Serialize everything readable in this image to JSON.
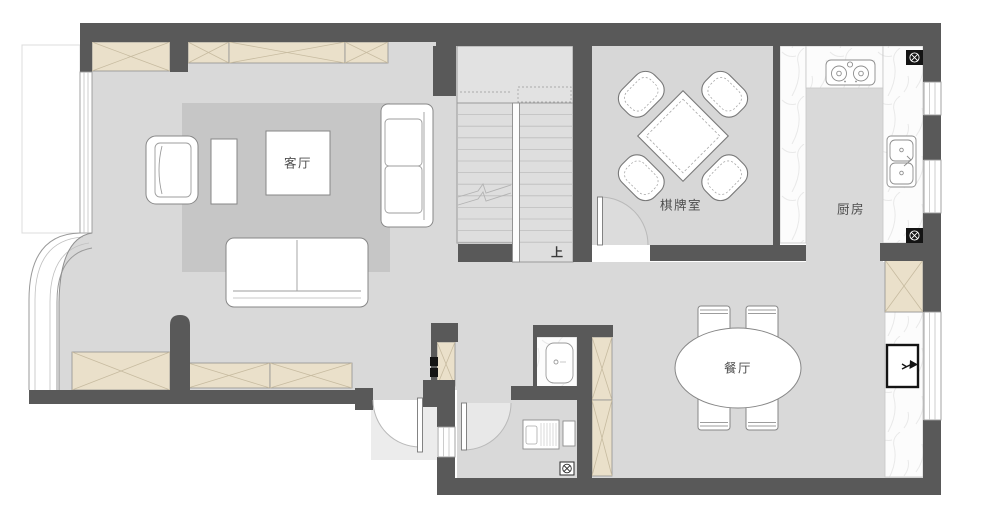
{
  "plan": {
    "type": "residential-floor-plan",
    "rooms": {
      "living_room": {
        "label": "客厅"
      },
      "game_room": {
        "label": "棋牌室"
      },
      "kitchen": {
        "label": "厨房"
      },
      "dining_room": {
        "label": "餐厅"
      }
    },
    "stairs": {
      "direction_label": "上"
    },
    "colors": {
      "wall": "#595959",
      "floor": "#D9D9D9",
      "rug": "#C6C6C6",
      "stair_floor": "#DEDEDE",
      "cabinet": "#EAE0CA",
      "cabinet_cross": "#C7BBA0",
      "marble_counter": "#FCFCFC",
      "furniture_outline": "#878787",
      "door_arc": "#B9B9B9",
      "background": "#FFFFFF"
    }
  }
}
